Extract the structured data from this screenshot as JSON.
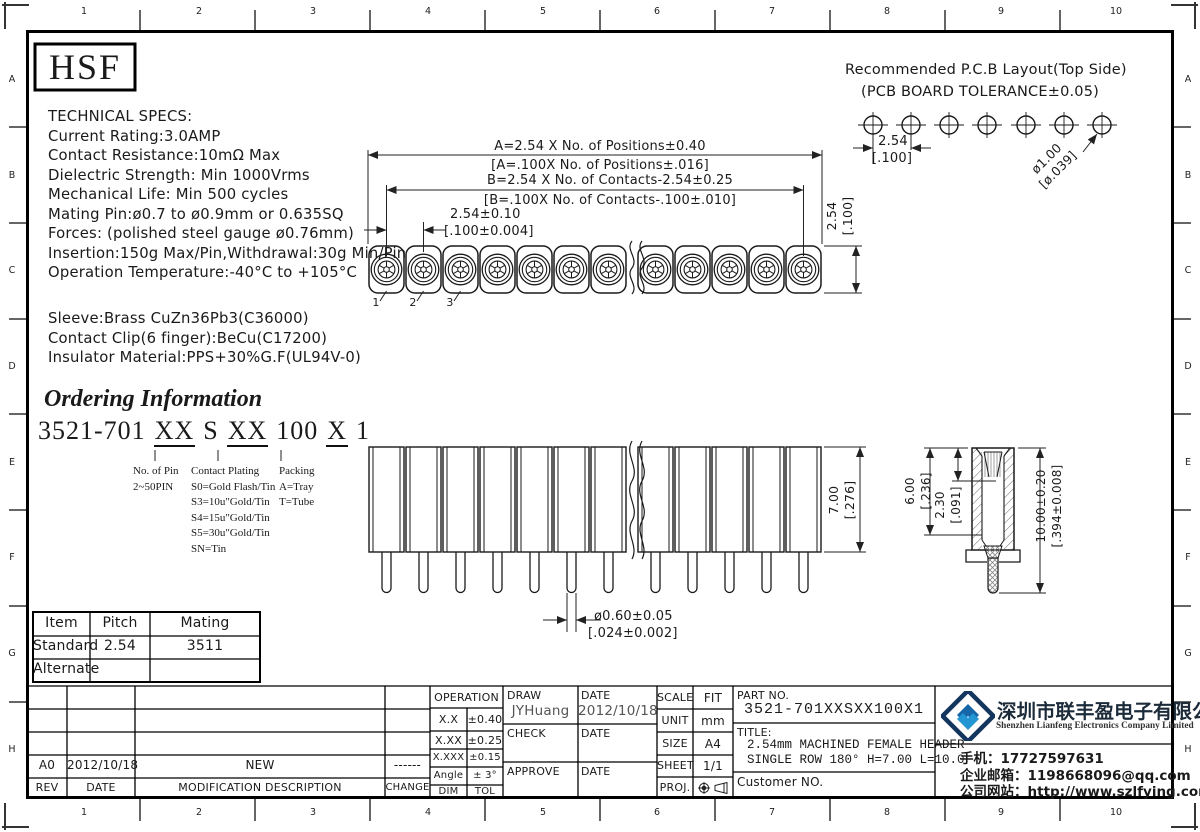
{
  "sheet": {
    "grid_cols": [
      "1",
      "2",
      "3",
      "4",
      "5",
      "6",
      "7",
      "8",
      "9",
      "10"
    ],
    "grid_rows": [
      "A",
      "B",
      "C",
      "D",
      "E",
      "F",
      "G",
      "H"
    ]
  },
  "logo": {
    "text": "HSF"
  },
  "specs": {
    "lines": [
      "TECHNICAL SPECS:",
      "Current Rating:3.0AMP",
      "Contact Resistance:10mΩ Max",
      "Dielectric Strength: Min 1000Vrms",
      "Mechanical Life: Min 500 cycles",
      "Mating Pin:ø0.7 to ø0.9mm or 0.635SQ",
      "Forces: (polished steel gauge ø0.76mm)",
      "Insertion:150g Max/Pin,Withdrawal:30g Min/Pin",
      "Operation Temperature:-40°C to +105°C"
    ],
    "materials": [
      "Sleeve:Brass CuZn36Pb3(C36000)",
      "Contact Clip(6 finger):BeCu(C17200)",
      "Insulator Material:PPS+30%G.F(UL94V-0)"
    ]
  },
  "pcb": {
    "title1": "Recommended P.C.B Layout(Top Side)",
    "title2": "(PCB BOARD TOLERANCE±0.05)",
    "pitch_mm": "2.54",
    "pitch_in": "[.100]",
    "hole_mm": "ø1.00",
    "hole_in": "[ø.039]"
  },
  "top_view": {
    "dim_a_mm": "A=2.54 X No. of Positions±0.40",
    "dim_a_in": "[A=.100X No. of Positions±.016]",
    "dim_b_mm": "B=2.54 X No. of Contacts-2.54±0.25",
    "dim_b_in": "[B=.100X No. of Contacts-.100±.010]",
    "dim_pitch_mm": "2.54±0.10",
    "dim_pitch_in": "[.100±0.004]",
    "dim_row_mm": "2.54",
    "dim_row_in": "[.100]",
    "pin_labels": [
      "1",
      "2",
      "3"
    ]
  },
  "front_view": {
    "dim_h_mm": "7.00",
    "dim_h_in": "[.276]",
    "dim_pin_mm": "ø0.60±0.05",
    "dim_pin_in": "[.024±0.002]"
  },
  "side_view": {
    "dim_inner_mm": "6.00",
    "dim_inner_in": "[.236]",
    "dim_depth_mm": "2.30",
    "dim_depth_in": "[.091]",
    "dim_total_mm": "10.00±0.20",
    "dim_total_in": "[.394±0.008]"
  },
  "ordering": {
    "title": "Ordering Information",
    "code": [
      "3521-701",
      "XX",
      "S",
      "XX",
      "100",
      "X",
      "1"
    ],
    "pin_header": "No. of Pin",
    "pin_range": "2~50PIN",
    "plating_header": "Contact Plating",
    "plating_options": [
      "S0=Gold Flash/Tin",
      "S3=10u\"Gold/Tin",
      "S4=15u\"Gold/Tin",
      "S5=30u\"Gold/Tin",
      "SN=Tin"
    ],
    "packing_header": "Packing",
    "packing_options": [
      "A=Tray",
      "T=Tube"
    ]
  },
  "mating_table": {
    "headers": [
      "Item",
      "Pitch",
      "Mating"
    ],
    "rows": [
      [
        "Standard",
        "2.54",
        "3511"
      ],
      [
        "Alternate",
        "",
        ""
      ]
    ]
  },
  "revision": {
    "entry": {
      "rev": "A0",
      "date": "2012/10/18",
      "desc": "NEW",
      "change": "------"
    },
    "headers": {
      "rev": "REV",
      "date": "DATE",
      "desc": "MODIFICATION DESCRIPTION",
      "change": "CHANGE"
    }
  },
  "tolerances": {
    "header": "OPERATION",
    "rows": [
      [
        "X.X",
        "±0.40"
      ],
      [
        "X.XX",
        "±0.25"
      ],
      [
        "X.XXX",
        "±0.15"
      ],
      [
        "Angle",
        "± 3°"
      ],
      [
        "DIM",
        "TOL"
      ]
    ]
  },
  "signoff": {
    "draw_label": "DRAW",
    "draw_name": "JYHuang",
    "draw_date_label": "DATE",
    "draw_date": "2012/10/18",
    "check_label": "CHECK",
    "check_date_label": "DATE",
    "approve_label": "APPROVE",
    "approve_date_label": "DATE"
  },
  "info": {
    "scale_label": "SCALE",
    "scale": "FIT",
    "unit_label": "UNIT",
    "unit": "mm",
    "size_label": "SIZE",
    "size": "A4",
    "sheet_label": "SHEET",
    "sheet": "1/1",
    "proj_label": "PROJ."
  },
  "part": {
    "part_no_label": "PART NO.",
    "part_no": "3521-701XXSXX100X1",
    "title_label": "TITLE:",
    "title_line1": "2.54mm MACHINED FEMALE HEADER",
    "title_line2": "SINGLE ROW 180° H=7.00 L=10.0",
    "customer_label": "Customer NO."
  },
  "company": {
    "name_cn": "深圳市联丰盈电子有限公司",
    "name_en": "Shenzhen Lianfeng Electronics Company Limited",
    "phone": "手机：17727597631",
    "email": "企业邮箱：1198668096@qq.com",
    "website": "公司网站：http://www.szlfying.com"
  },
  "colors": {
    "accent_blue": "#2196d3",
    "navy": "#14355e",
    "grey_text": "#555555"
  }
}
